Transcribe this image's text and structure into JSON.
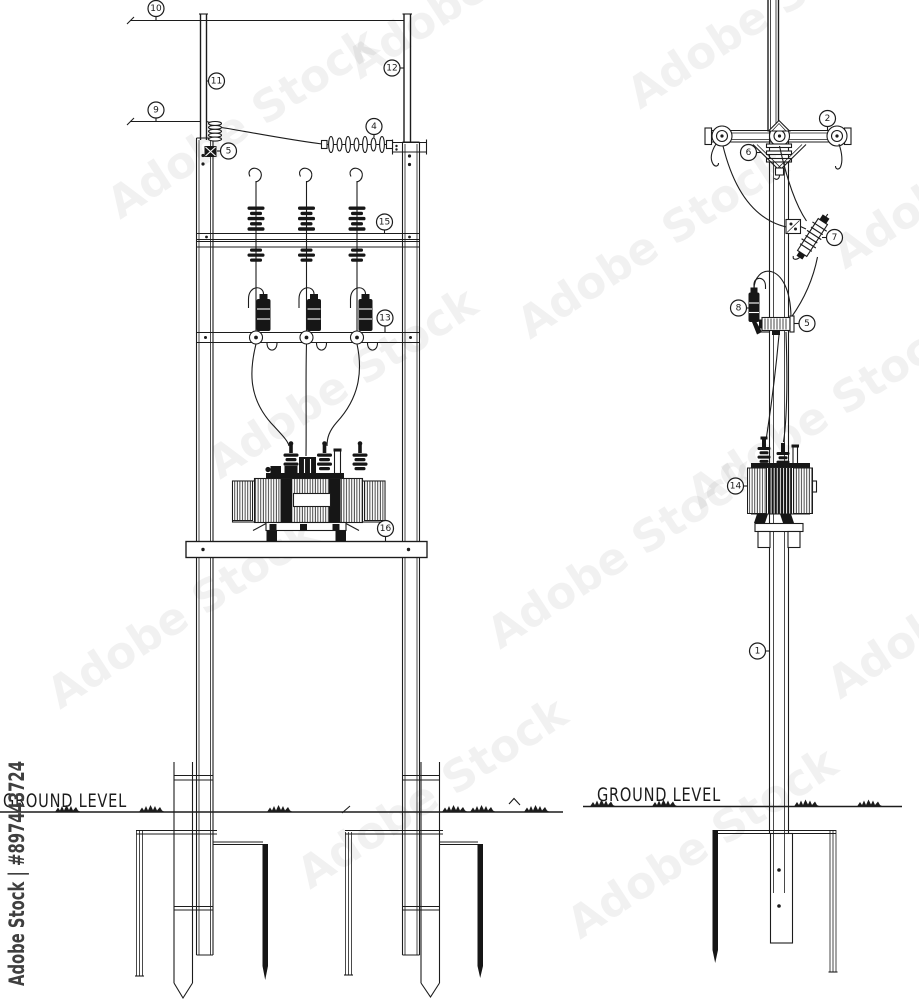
{
  "colors": {
    "line": "#1c1c1c",
    "background": "#ffffff",
    "watermark_side": "#3f3f3f"
  },
  "watermark": {
    "side_text": "Adobe Stock | #897443724",
    "diagonal_text": "Adobe Stock"
  },
  "ground": {
    "left_label": "GROUND LEVEL",
    "right_label": "GROUND LEVEL"
  },
  "callouts": {
    "front": {
      "c10": "10",
      "c11": "11",
      "c9": "9",
      "c5": "5",
      "c4": "4",
      "c12": "12",
      "c15": "15",
      "c13": "13",
      "c16": "16"
    },
    "side": {
      "c2": "2",
      "c6": "6",
      "c7": "7",
      "c8": "8",
      "c5": "5",
      "c14": "14",
      "c1": "1"
    }
  }
}
